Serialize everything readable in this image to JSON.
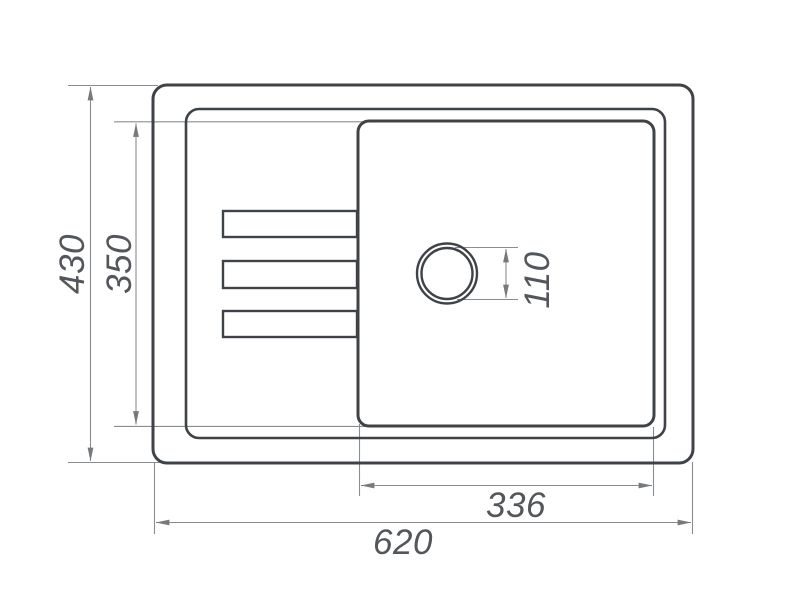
{
  "diagram": {
    "type": "technical-drawing",
    "subject": "kitchen-sink-top-view",
    "labels": {
      "overall_height": "430",
      "bowl_height": "350",
      "drain_diameter": "110",
      "bowl_width": "336",
      "overall_width": "620"
    },
    "colors": {
      "line_dark": "#3f4347",
      "line_thin": "#898d91",
      "text": "#53575b",
      "background": "#ffffff"
    }
  }
}
